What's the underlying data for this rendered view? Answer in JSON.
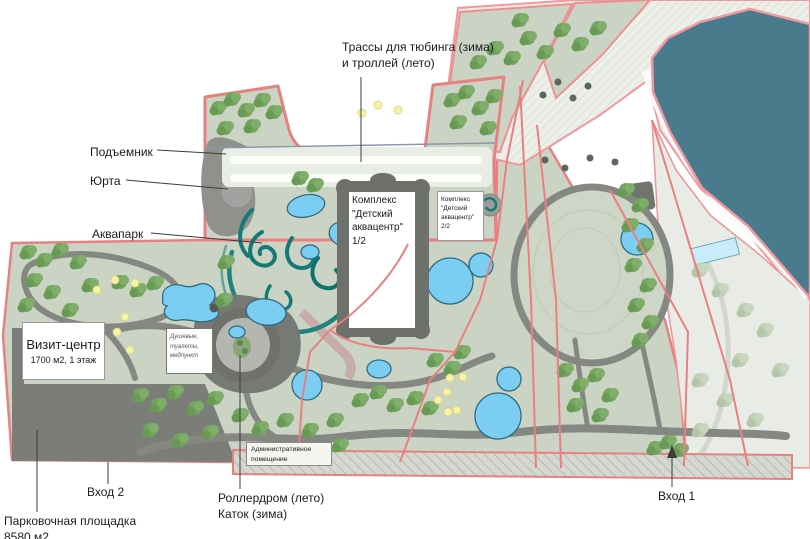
{
  "colors": {
    "boundary": "#e88080",
    "zone_fill": "#cbd4c4",
    "lake": "#4a7b8c",
    "pool": "#7bcdf1",
    "slide": "#157d78",
    "path": "#858783",
    "parking": "#7b7d79",
    "tree": "#74a55f"
  },
  "callouts": {
    "tubing": {
      "label": "Трассы для тюбинга (зима)\nи троллей (лето)"
    },
    "lift": {
      "label": "Подъемник"
    },
    "yurt": {
      "label": "Юрта"
    },
    "aquapark": {
      "label": "Аквапарк"
    },
    "entrance2": {
      "label": "Вход 2"
    },
    "parking_area": {
      "label": "Парковочная площадка\n8580 м2"
    },
    "rollerdrome": {
      "label": "Роллердром (лето)\nКаток (зима)"
    },
    "entrance1": {
      "label": "Вход 1"
    }
  },
  "map_boxes": {
    "visit_center": {
      "title": "Визит-центр",
      "subtitle": "1700 м2, 1 этаж"
    },
    "kids_aquacenter_1": {
      "label": "Комплекс\n\"Детский\nаквацентр\"\n1/2"
    },
    "kids_aquacenter_2": {
      "label": "Комплекс\n\"Детский\nаквацентр\"\n2/2"
    },
    "showers": {
      "label": "Душевые,\nтуалеты,\nмедпункт"
    },
    "admin": {
      "label": "Административное\nпомещение"
    }
  }
}
